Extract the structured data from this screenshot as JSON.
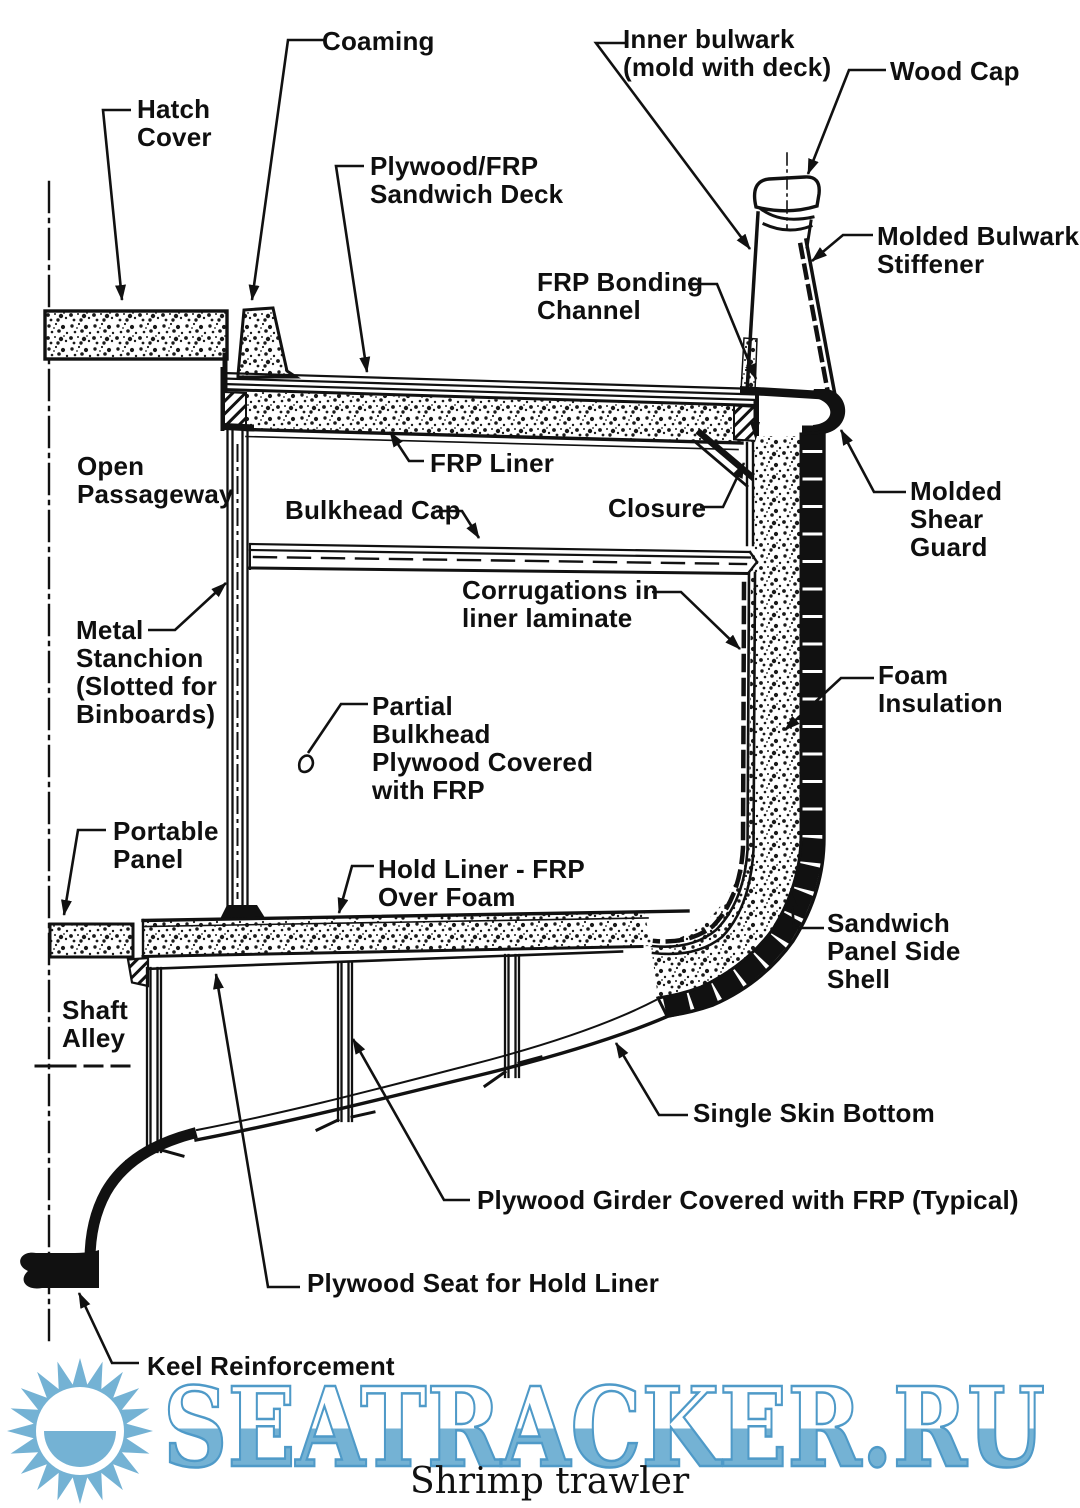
{
  "diagram": {
    "title_caption": "Shrimp trawler",
    "ink_color": "#111111",
    "watermark": {
      "text": "SEATRACKER.RU",
      "fill_blue": "#74b2d4",
      "outline_blue": "#4f9ac8"
    },
    "labels": {
      "coaming": "Coaming",
      "hatch_cover": "Hatch\nCover",
      "plywood_frp_sandwich_deck": "Plywood/FRP\nSandwich Deck",
      "inner_bulwark": "Inner bulwark\n(mold with deck)",
      "wood_cap": "Wood Cap",
      "molded_bulwark_stiffener": "Molded Bulwark\nStiffener",
      "frp_bonding_channel": "FRP Bonding\nChannel",
      "frp_liner": "FRP Liner",
      "closure": "Closure",
      "molded_shear_guard": "Molded Shear\nGuard",
      "open_passageway": "Open\nPassageway",
      "bulkhead_cap": "Bulkhead Cap",
      "corrugations": "Corrugations in\nliner laminate",
      "metal_stanchion": "Metal\nStanchion\n(Slotted for\nBinboards)",
      "foam_insulation": "Foam\nInsulation",
      "partial_bulkhead": "Partial\nBulkhead\nPlywood Covered\nwith FRP",
      "portable_panel": "Portable\nPanel",
      "hold_liner": "Hold Liner - FRP\nOver Foam",
      "sandwich_panel_side_shell": "Sandwich\nPanel Side\nShell",
      "shaft_alley": "Shaft\nAlley",
      "single_skin_bottom": "Single Skin Bottom",
      "plywood_girder": "Plywood Girder Covered with FRP (Typical)",
      "plywood_seat": "Plywood Seat for Hold Liner",
      "keel_reinforcement": "Keel Reinforcement"
    }
  }
}
